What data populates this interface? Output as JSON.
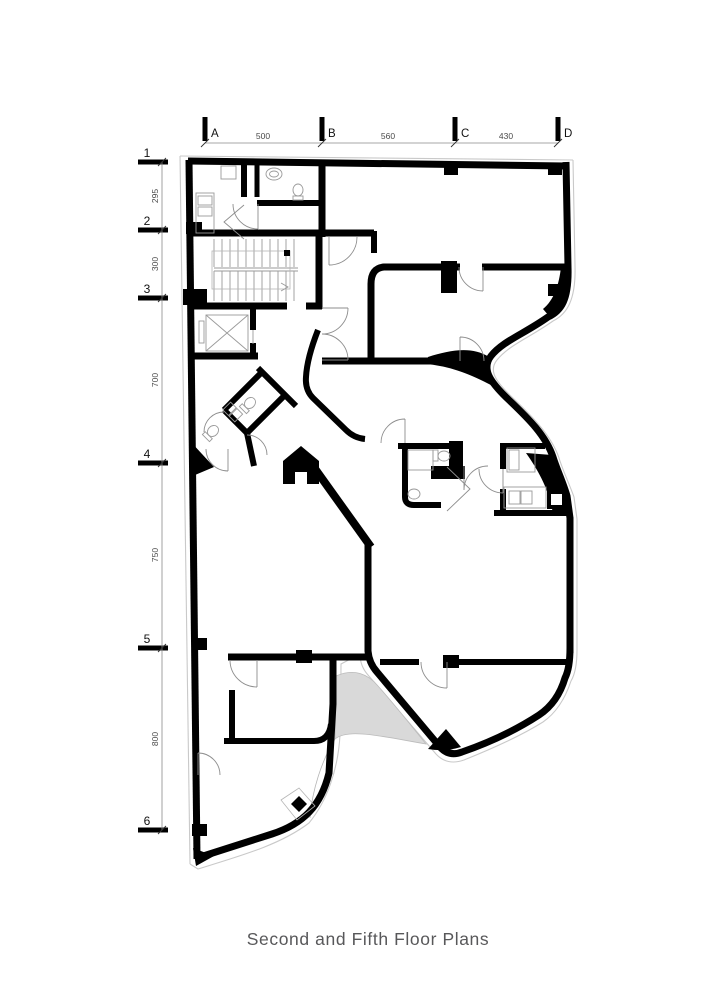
{
  "caption": "Second and Fifth Floor Plans",
  "grid": {
    "columns": [
      {
        "label": "A"
      },
      {
        "label": "B"
      },
      {
        "label": "C"
      },
      {
        "label": "D"
      }
    ],
    "column_dims": [
      {
        "value": "500"
      },
      {
        "value": "560"
      },
      {
        "value": "430"
      }
    ],
    "rows": [
      {
        "label": "1"
      },
      {
        "label": "2"
      },
      {
        "label": "3"
      },
      {
        "label": "4"
      },
      {
        "label": "5"
      },
      {
        "label": "6"
      }
    ],
    "row_dims": [
      {
        "value": "295"
      },
      {
        "value": "300"
      },
      {
        "value": "700"
      },
      {
        "value": "750"
      },
      {
        "value": "800"
      }
    ]
  },
  "plan": {
    "fixtures": [
      "staircase",
      "elevator",
      "toilet",
      "sink",
      "bed",
      "cabinet",
      "kitchen-counter",
      "stove",
      "door-swing",
      "ramp"
    ]
  },
  "colors": {
    "wall": "#000000",
    "outer_outline": "#c9c9c9",
    "ramp": "#d9d9d9",
    "dim_text": "#4a4a4a",
    "caption": "#58585a"
  }
}
